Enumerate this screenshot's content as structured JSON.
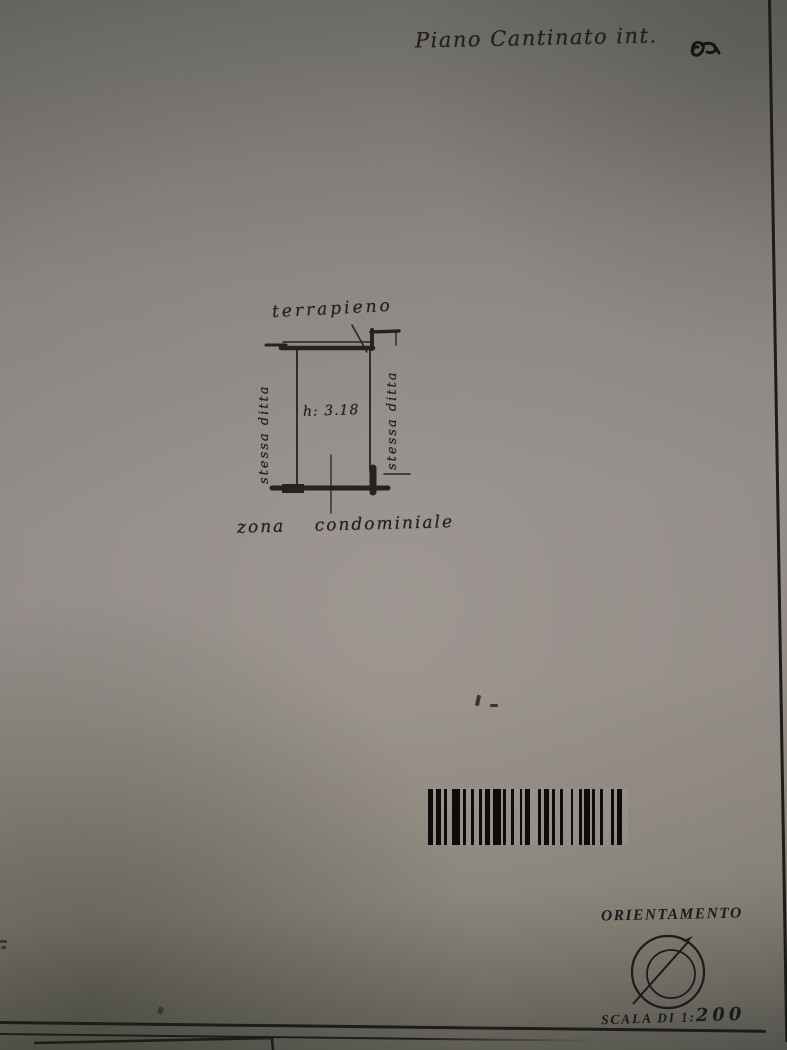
{
  "document": {
    "handwritten_title": "Piano Cantinato int.",
    "plan": {
      "top_label": "terrapieno",
      "left_label": "stessa ditta",
      "right_label": "stessa ditta",
      "room_height": "h: 3.18",
      "bottom_label": "zona condominiale"
    },
    "orientation": {
      "title": "ORIENTAMENTO",
      "scale_prefix": "SCALA DI 1:",
      "scale_value": "200"
    },
    "barcode": {
      "pattern": "212112311212112131121211231121121312112112131121"
    }
  },
  "colors": {
    "ink": "#24211d",
    "page_center": "#938d8a",
    "page_top": "#6f6f6a",
    "page_bottom": "#575650"
  }
}
